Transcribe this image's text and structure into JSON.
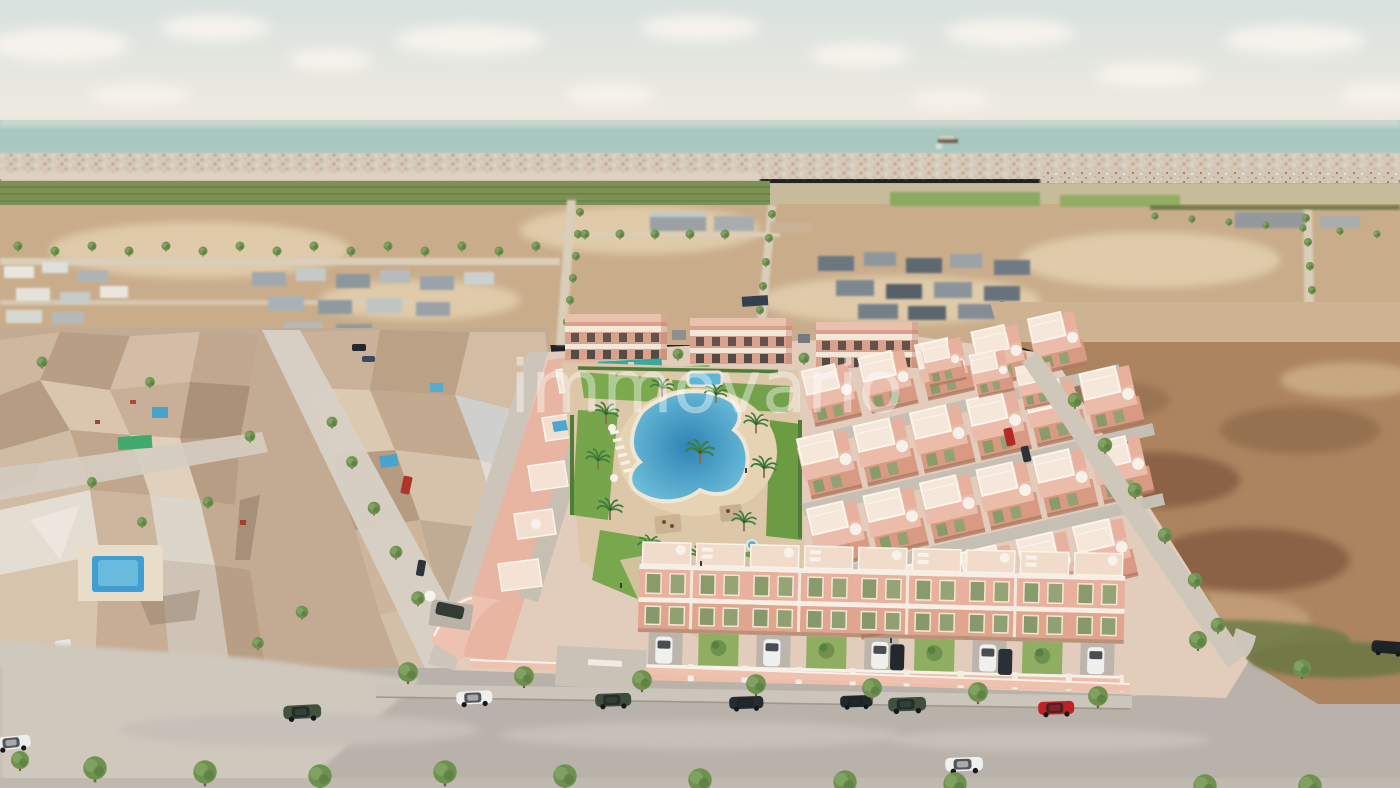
{
  "watermark": {
    "text": "immovario",
    "color": "rgba(255,255,255,0.40)"
  },
  "scene": {
    "name": "aerial-render-new-residential-development",
    "description": "Aerial 3D architectural render of a new salmon-pink townhouse development with a communal lagoon pool and gardens, flanked by an existing low-poly photogrammetry neighborhood on the left, empty tan plots and brown fields on the right, a distant coastal town, the sea and a pale cloudy sky on the horizon, and a gray street with parked cars and small green trees in the foreground.",
    "colors": {
      "sky_top": "#d8e1de",
      "sky_bottom": "#f1ebe1",
      "cloud": "#f9f5ee",
      "sea": "#a8c8bf",
      "distant_city": "#d6cabb",
      "grove": "#7d9154",
      "dirt": "#c9ad8b",
      "field": "#ac8460",
      "mesh_town": "#c3ab93",
      "development_plate": "#e2cdbd",
      "house_pink": "#e9b19d",
      "house_trim": "#f6efe6",
      "shutter_green": "#8a9b6b",
      "lawn": "#74a24b",
      "pool_edge": "#74c4de",
      "pool_deep": "#2e84b4",
      "path": "#dcc7a8",
      "road": "#b8b2aa",
      "tree": "#6f9150",
      "car_red": "#bf2125",
      "car_green": "#42523f",
      "car_white": "#f0f0ee",
      "car_black": "#23282c"
    },
    "features": [
      "sea-horizon",
      "cargo-ship",
      "distant-coastal-town",
      "palm-grove-band",
      "empty-plots-with-tree-lined-streets",
      "existing-neighborhood-mesh",
      "neighborhood-swimming-pools",
      "new-development",
      "apartment-blocks",
      "playground",
      "communal-garden",
      "lagoon-pool",
      "kids-pool",
      "sunbeds",
      "palm-trees",
      "townhouse-rows",
      "roof-terraces-with-umbrellas",
      "street-facing-houses-with-driveways",
      "boundary-road",
      "brown-field",
      "main-street",
      "parked-cars",
      "street-trees"
    ]
  }
}
